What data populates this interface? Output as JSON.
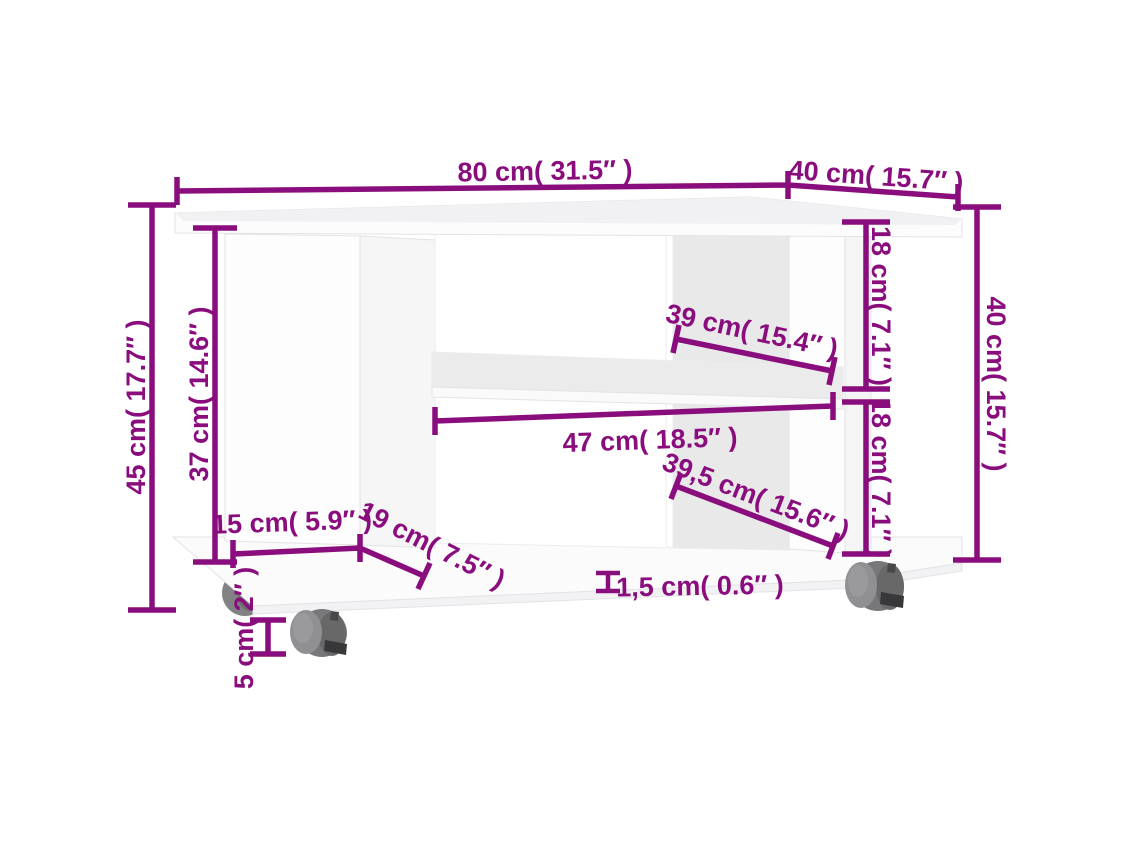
{
  "diagram": {
    "type": "product-dimension-diagram",
    "subject": "TV cabinet with casters",
    "accent_color": "#8a0d7e",
    "furniture_color": "#ffffff",
    "caster_color": "#78787a",
    "dimensions": [
      {
        "id": "top-width",
        "label": "80 cm( 31.5″ )"
      },
      {
        "id": "top-depth",
        "label": "40 cm( 15.7″ )"
      },
      {
        "id": "body-height",
        "label": "40 cm( 15.7″ )"
      },
      {
        "id": "upper-opening-height",
        "label": "18 cm( 7.1″ )"
      },
      {
        "id": "lower-opening-height",
        "label": "18 cm( 7.1″ )"
      },
      {
        "id": "upper-shelf-width",
        "label": "39 cm( 15.4″ )"
      },
      {
        "id": "inner-width",
        "label": "47 cm( 18.5″ )"
      },
      {
        "id": "lower-opening-width",
        "label": "39,5 cm( 15.6″ )"
      },
      {
        "id": "left-inner-height",
        "label": "37 cm( 14.6″ )"
      },
      {
        "id": "total-height",
        "label": "45 cm( 17.7″ )"
      },
      {
        "id": "left-panel-width",
        "label": "15 cm( 5.9″ )"
      },
      {
        "id": "left-panel-depth",
        "label": "19 cm( 7.5″ )"
      },
      {
        "id": "caster-height",
        "label": "5 cm( 2″ )"
      },
      {
        "id": "panel-thickness",
        "label": "1,5 cm( 0.6″ )"
      }
    ]
  }
}
